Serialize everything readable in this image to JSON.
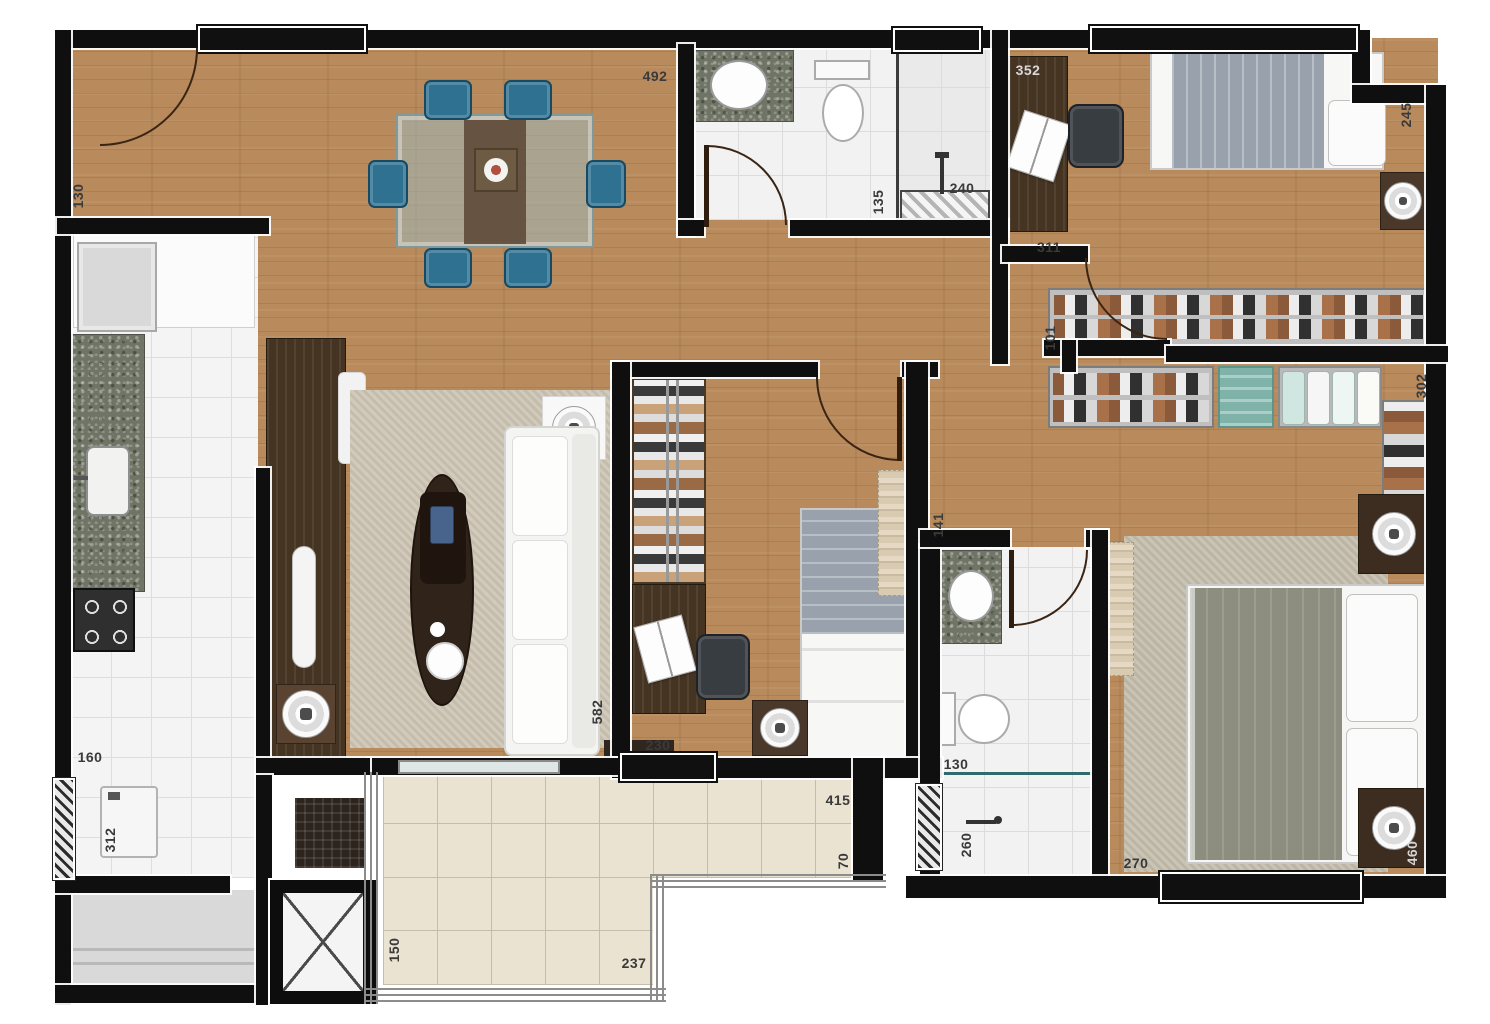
{
  "plan": {
    "width": 1490,
    "height": 1024,
    "description": "apartment floor plan, top-down rendered"
  },
  "labels": [
    {
      "text": "130",
      "x": 78,
      "y": 196,
      "rot": true
    },
    {
      "text": "492",
      "x": 655,
      "y": 76
    },
    {
      "text": "135",
      "x": 878,
      "y": 202,
      "rot": true
    },
    {
      "text": "240",
      "x": 962,
      "y": 188
    },
    {
      "text": "352",
      "x": 1028,
      "y": 70,
      "color": "#d8d8d8"
    },
    {
      "text": "245",
      "x": 1406,
      "y": 115,
      "rot": true
    },
    {
      "text": "311",
      "x": 1049,
      "y": 247
    },
    {
      "text": "101",
      "x": 1050,
      "y": 338,
      "rot": true
    },
    {
      "text": "302",
      "x": 1421,
      "y": 386,
      "rot": true
    },
    {
      "text": "141",
      "x": 938,
      "y": 525,
      "rot": true
    },
    {
      "text": "582",
      "x": 597,
      "y": 712,
      "rot": true
    },
    {
      "text": "230",
      "x": 658,
      "y": 745
    },
    {
      "text": "160",
      "x": 90,
      "y": 757
    },
    {
      "text": "312",
      "x": 110,
      "y": 840,
      "rot": true
    },
    {
      "text": "150",
      "x": 394,
      "y": 950,
      "rot": true
    },
    {
      "text": "237",
      "x": 634,
      "y": 963
    },
    {
      "text": "415",
      "x": 838,
      "y": 800
    },
    {
      "text": "70",
      "x": 843,
      "y": 861,
      "rot": true
    },
    {
      "text": "130",
      "x": 956,
      "y": 764
    },
    {
      "text": "260",
      "x": 966,
      "y": 845,
      "rot": true
    },
    {
      "text": "270",
      "x": 1136,
      "y": 863
    },
    {
      "text": "460",
      "x": 1412,
      "y": 853,
      "rot": true,
      "color": "#d4d4d4"
    }
  ],
  "colors": {
    "wood": "#b88a5c",
    "wall": "#0f0f0f",
    "kitchen_tile": "#f4f4f4",
    "bath_tile": "#f2f2f2",
    "balcony_tile": "#eae3d2",
    "corridor": "#d9d9d9",
    "rug_living": "#cfc6b5",
    "rug_suite": "#c6bfae",
    "chair_teal": "#2f7191",
    "granite": "#6f7465",
    "dark_furniture": "#453422",
    "blanket_gray": "#99a2ac",
    "duvet_green": "#8e8e80",
    "speaker_base": "#4a382a",
    "table_glass": "#9cb8ba"
  }
}
